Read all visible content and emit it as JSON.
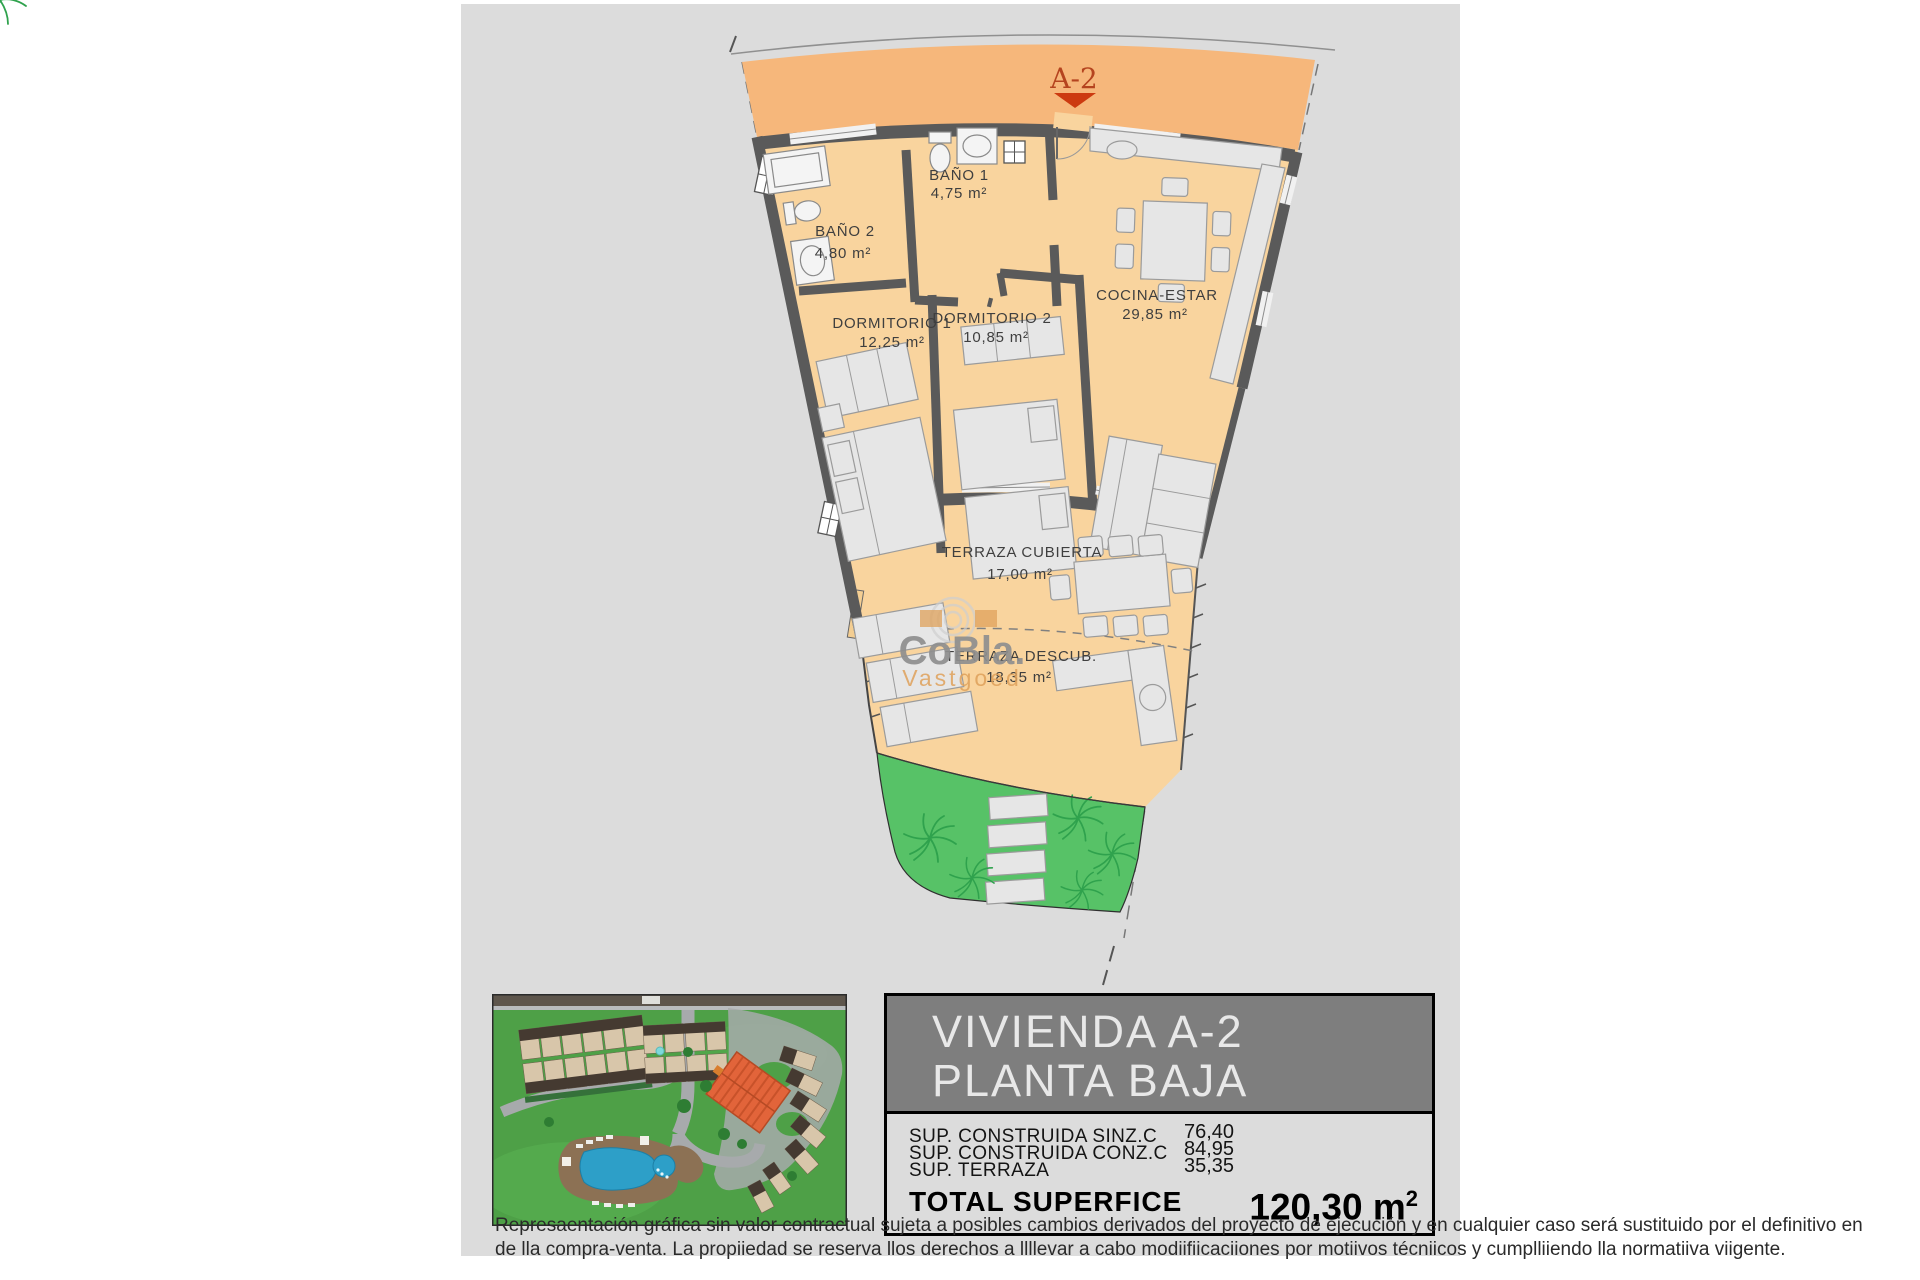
{
  "plan": {
    "unit_marker": "A-2",
    "rooms": [
      {
        "name": "BAÑO 1",
        "area": "4,75 m²"
      },
      {
        "name": "BAÑO 2",
        "area": "4,80 m²"
      },
      {
        "name": "DORMITORIO 1",
        "area": "12,25 m²"
      },
      {
        "name": "DORMITORIO 2",
        "area": "10,85 m²"
      },
      {
        "name": "COCINA-ESTAR",
        "area": "29,85 m²"
      },
      {
        "name": "TERRAZA CUBIERTA",
        "area": "17,00 m²"
      },
      {
        "name": "TERRAZA DESCUB.",
        "area": "18,35 m²"
      }
    ],
    "watermark": {
      "brand": "CoBla.",
      "sub": "Vastgoed"
    }
  },
  "info_box": {
    "title_line1": "VIVIENDA A-2",
    "title_line2": "PLANTA BAJA",
    "rows": [
      {
        "label": "SUP. CONSTRUIDA SINZ.C",
        "value": "76,40"
      },
      {
        "label": "SUP. CONSTRUIDA CONZ.C",
        "value": "84,95"
      },
      {
        "label": "SUP. TERRAZA",
        "value": "35,35"
      }
    ],
    "total_label": "TOTAL SUPERFICE",
    "total_value": "120,30",
    "total_unit": "m",
    "total_unit_sup": "2"
  },
  "disclaimer": {
    "line1": "Represaentación gráfica sin valor contractual sujeta a posibles cambios derivados del proyecto de ejecución y en cualquier caso será sustituido por el definitivo en",
    "line2": "de lla compra-venta. La propiiedad se reserva llos derechos a llllevar a cabo modiifiicaciiones por motiivos técniicos y cumplliiendo lla normatiiva viigente."
  },
  "colors": {
    "panel": "#DCDCDC",
    "band": "#F6B77B",
    "room": "#F9D49E",
    "wall": "#5A5A5A",
    "furn": "#E6E6E6",
    "furnline": "#9B9B9B",
    "fixture": "#F4F4F4",
    "green": "#57C267",
    "palm": "#2FA24D",
    "label": "#3F3F3F",
    "marker": "#B5441F",
    "marker_tri": "#CC3A10",
    "wm_gray": "#8F8F8F",
    "wm_orange": "#DFA15B",
    "header_bg": "#7E7E7E",
    "header_text": "#E8E8E8",
    "box_bg": "#DCDCDC",
    "door": "#F4CE92"
  }
}
